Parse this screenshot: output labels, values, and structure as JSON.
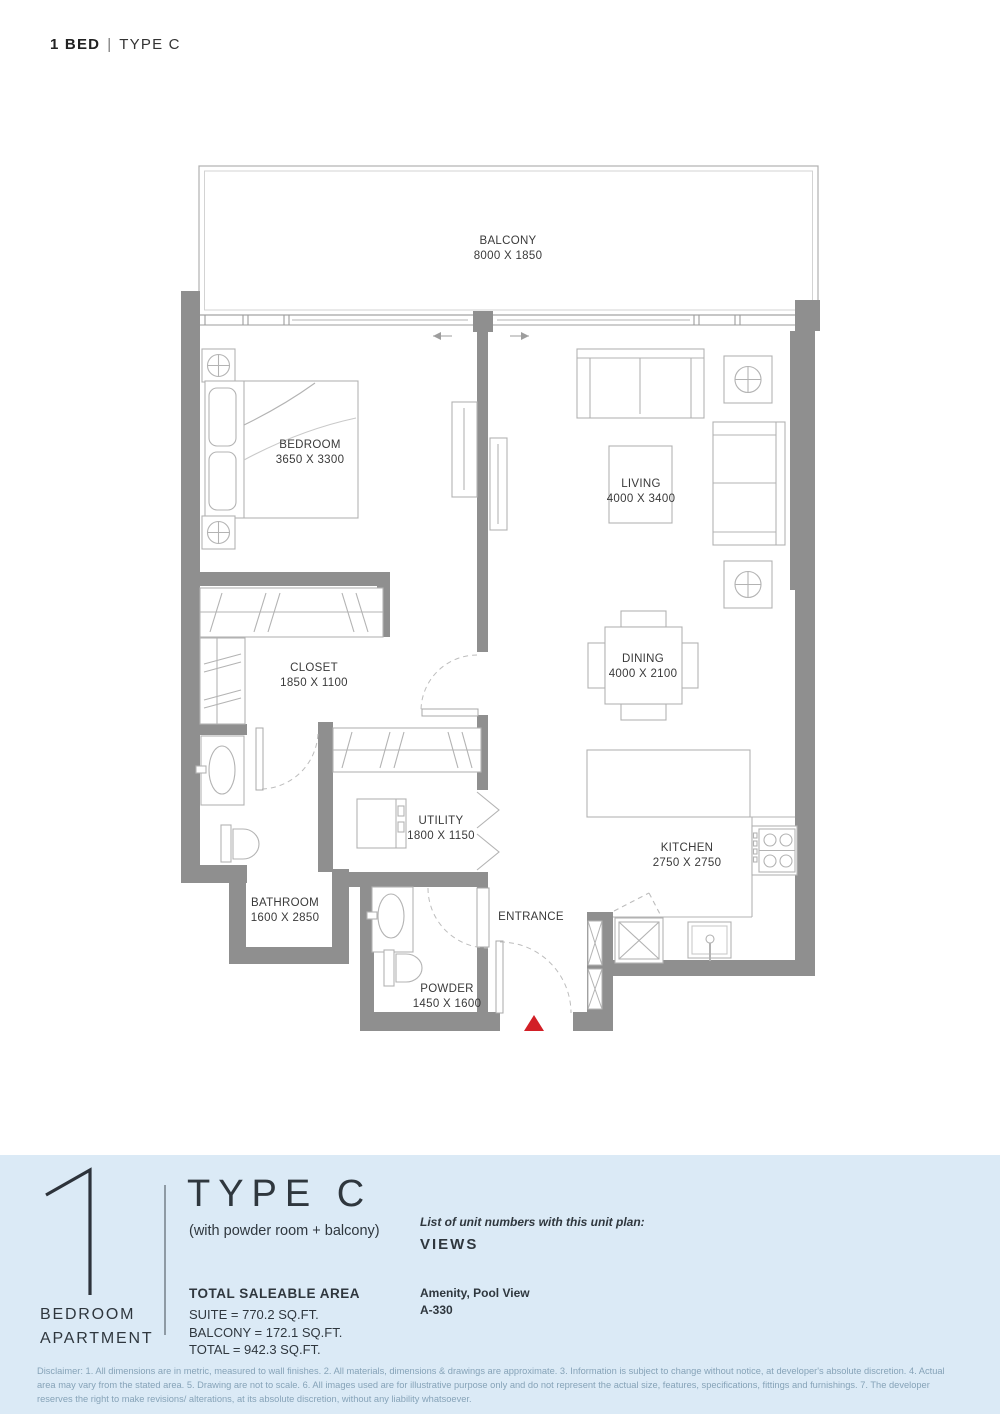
{
  "header": {
    "title_bold": "1 BED",
    "title_sep": "|",
    "title_rest": "TYPE C"
  },
  "plan": {
    "wall_color": "#8f8f8f",
    "entrance_marker_color": "#d21f26",
    "rooms": {
      "balcony": {
        "name": "BALCONY",
        "dims": "8000 X 1850"
      },
      "bedroom": {
        "name": "BEDROOM",
        "dims": "3650 X 3300"
      },
      "living": {
        "name": "LIVING",
        "dims": "4000 X 3400"
      },
      "dining": {
        "name": "DINING",
        "dims": "4000 X 2100"
      },
      "closet": {
        "name": "CLOSET",
        "dims": "1850 X 1100"
      },
      "utility": {
        "name": "UTILITY",
        "dims": "1800 X 1150"
      },
      "bathroom": {
        "name": "BATHROOM",
        "dims": "1600 X 2850"
      },
      "kitchen": {
        "name": "KITCHEN",
        "dims": "2750 X 2750"
      },
      "powder": {
        "name": "POWDER",
        "dims": "1450 X 1600"
      },
      "entrance": {
        "name": "ENTRANCE"
      }
    }
  },
  "footer": {
    "background_color": "#dbeaf6",
    "unit_number": "1",
    "unit_label_line1": "BEDROOM",
    "unit_label_line2": "APARTMENT",
    "type_title": "TYPE C",
    "type_subtitle": "(with powder room + balcony)",
    "area_heading": "TOTAL SALEABLE AREA",
    "area_lines": [
      "SUITE = 770.2 SQ.FT.",
      "BALCONY = 172.1 SQ.FT.",
      "TOTAL = 942.3 SQ.FT."
    ],
    "units_list_label": "List of unit numbers with this unit plan:",
    "views_label": "VIEWS",
    "amenity_line": "Amenity, Pool View",
    "unit_numbers": "A-330"
  },
  "disclaimer": "Disclaimer: 1. All dimensions are in metric, measured to wall finishes. 2. All materials, dimensions & drawings are approximate. 3. Information is subject to change without notice, at developer's absolute discretion. 4. Actual area may vary from the stated area. 5. Drawing are not to scale. 6. All images used are for illustrative purpose only and do not represent the actual size, features, specifications, fittings and furnishings. 7. The developer reserves the right to make revisions/ alterations, at its absolute discretion, without any liability whatsoever."
}
